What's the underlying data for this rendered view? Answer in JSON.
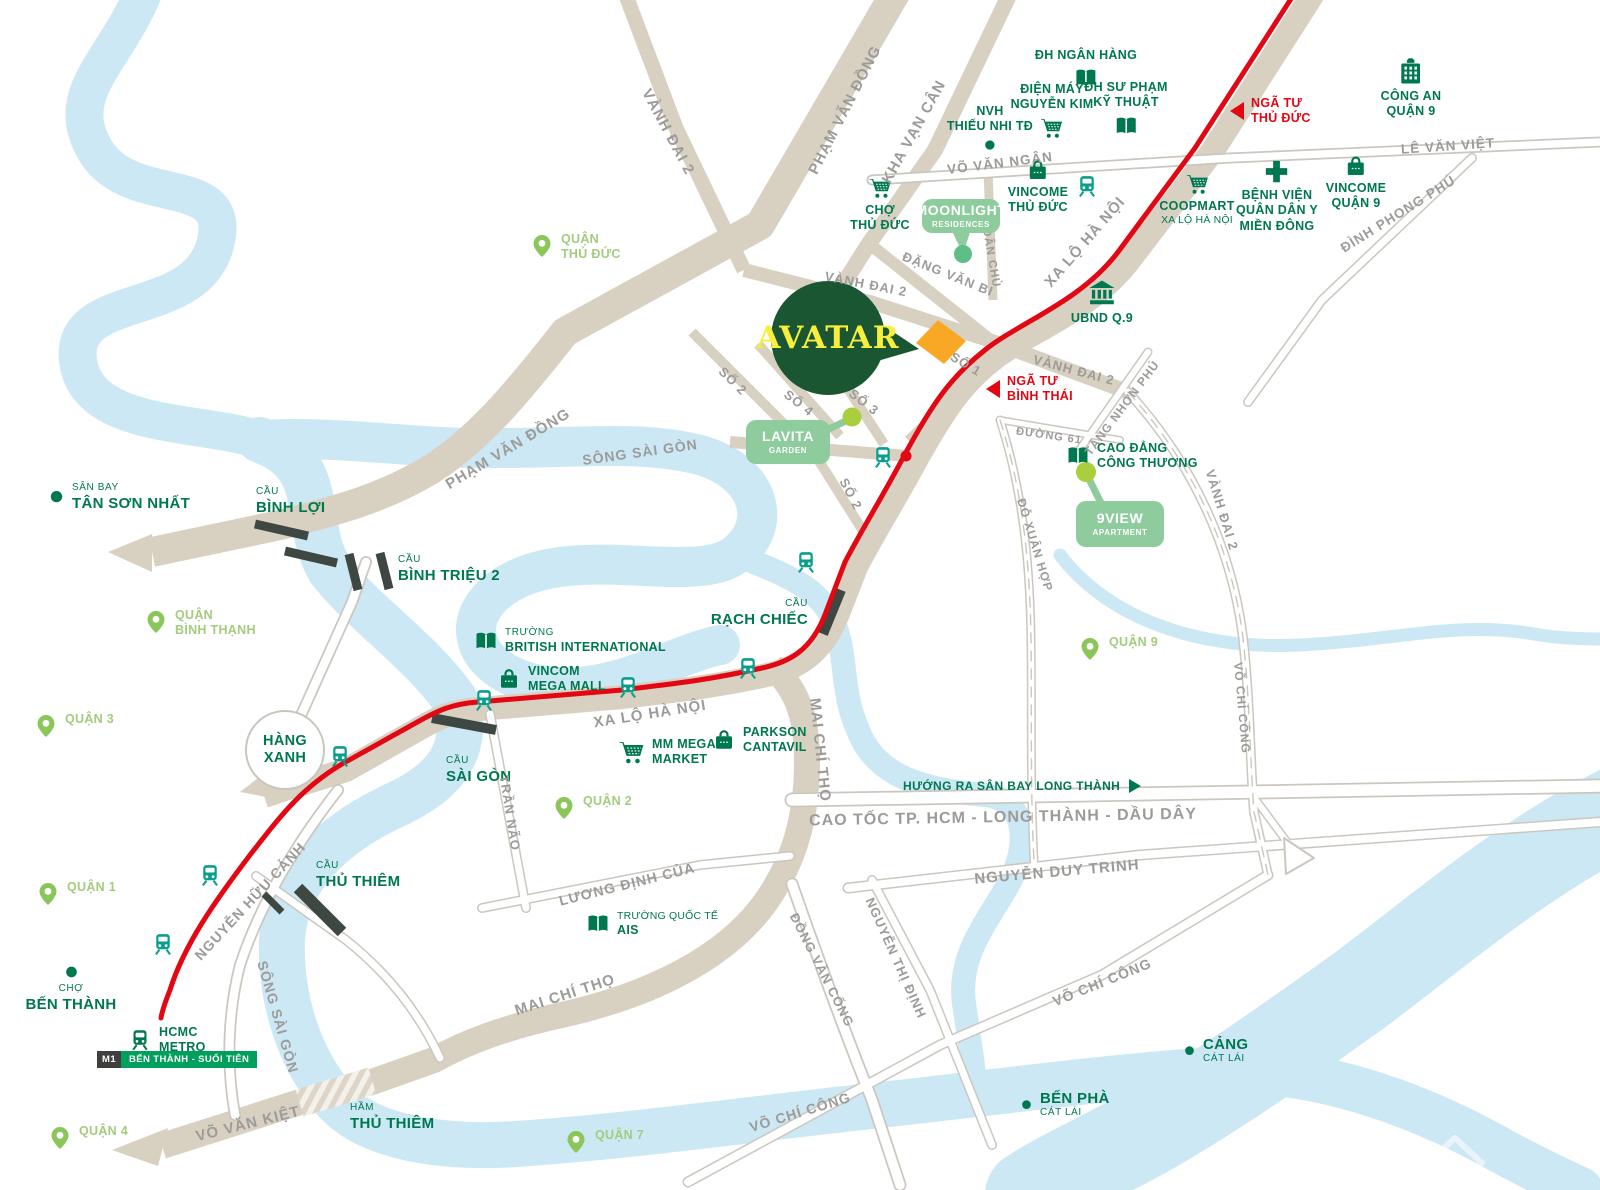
{
  "map": {
    "project": {
      "name": "AVATAR",
      "bubble_color": "#1b5633",
      "text_color": "#f8ef3d",
      "site_color": "#f9a826"
    },
    "colors": {
      "landmark_green": "#00784f",
      "district_green": "#a3cc7d",
      "pin_green": "#8bc65a",
      "metro_red": "#e30613",
      "road_beige": "#d8d1c2",
      "river_blue": "#cde8f5",
      "mint_box": "#8ecb9d",
      "train_teal": "#0a9f8c",
      "label_gray": "#9c9b99",
      "metro_badge_green": "#00a05c",
      "bridge_dark": "#3e4742"
    },
    "hang_xanh": {
      "lines": [
        "HÀNG",
        "XANH"
      ]
    },
    "direction_sign": {
      "text": "HƯỚNG RA SÂN BAY LONG THÀNH",
      "x": 903,
      "y": 779
    },
    "metro": {
      "badge": {
        "m1": "M1",
        "name": "BẾN THÀNH - SUỐI TIÊN",
        "x": 97,
        "y": 1051
      },
      "stations": [
        [
          1087,
          186
        ],
        [
          883,
          457
        ],
        [
          806,
          562
        ],
        [
          748,
          668
        ],
        [
          628,
          687
        ],
        [
          484,
          700
        ],
        [
          340,
          756
        ],
        [
          210,
          875
        ],
        [
          163,
          944
        ]
      ],
      "terminus_dot": [
        906,
        456
      ]
    },
    "districts": [
      {
        "id": "quan-thu-duc",
        "lines": [
          "QUẬN",
          "THỦ ĐỨC"
        ],
        "x": 530,
        "y": 232
      },
      {
        "id": "quan-binh-thanh",
        "lines": [
          "QUẬN",
          "BÌNH THẠNH"
        ],
        "x": 144,
        "y": 608
      },
      {
        "id": "quan-3",
        "lines": [
          "QUẬN 3"
        ],
        "x": 34,
        "y": 712
      },
      {
        "id": "quan-1",
        "lines": [
          "QUẬN 1"
        ],
        "x": 36,
        "y": 880
      },
      {
        "id": "quan-2",
        "lines": [
          "QUẬN 2"
        ],
        "x": 552,
        "y": 794
      },
      {
        "id": "quan-9",
        "lines": [
          "QUẬN 9"
        ],
        "x": 1078,
        "y": 635
      },
      {
        "id": "quan-7",
        "lines": [
          "QUẬN 7"
        ],
        "x": 564,
        "y": 1128
      },
      {
        "id": "quan-4",
        "lines": [
          "QUẬN 4"
        ],
        "x": 48,
        "y": 1124
      }
    ],
    "pois": [
      {
        "id": "dh-ngan-hang",
        "icon": "book",
        "layout": "icon-bottom",
        "x": 1086,
        "y": 48,
        "lines": [
          {
            "t": "ĐH NGÂN HÀNG",
            "c": "md"
          }
        ]
      },
      {
        "id": "dien-may-nguyen-kim",
        "icon": "cart",
        "layout": "icon-bottom",
        "x": 1052,
        "y": 82,
        "lines": [
          {
            "t": "ĐIỆN MÁY",
            "c": "md"
          },
          {
            "t": "NGUYỄN KIM",
            "c": "md"
          }
        ]
      },
      {
        "id": "dh-su-pham-ky-thuat",
        "icon": "book",
        "layout": "icon-bottom",
        "x": 1126,
        "y": 80,
        "lines": [
          {
            "t": "ĐH SƯ PHẠM",
            "c": "md"
          },
          {
            "t": "KỸ THUẬT",
            "c": "md"
          }
        ]
      },
      {
        "id": "nvh-thieu-nhi-td",
        "icon": "dot",
        "is": 14,
        "layout": "icon-bottom",
        "x": 990,
        "y": 104,
        "lines": [
          {
            "t": "NVH",
            "c": "md"
          },
          {
            "t": "THIẾU NHI TĐ",
            "c": "md"
          }
        ]
      },
      {
        "id": "cho-thu-duc",
        "icon": "cart",
        "layout": "icon-top",
        "x": 880,
        "y": 176,
        "lines": [
          {
            "t": "CHỢ",
            "c": "md"
          },
          {
            "t": "THỦ ĐỨC",
            "c": "md"
          }
        ]
      },
      {
        "id": "vincome-thu-duc",
        "icon": "bag",
        "layout": "icon-top",
        "x": 1038,
        "y": 158,
        "lines": [
          {
            "t": "VINCOME",
            "c": "md"
          },
          {
            "t": "THỦ ĐỨC",
            "c": "md"
          }
        ]
      },
      {
        "id": "cong-an-quan-9",
        "icon": "police",
        "is": 30,
        "layout": "icon-top",
        "x": 1411,
        "y": 56,
        "lines": [
          {
            "t": "CÔNG AN",
            "c": "md"
          },
          {
            "t": "QUẬN 9",
            "c": "md"
          }
        ]
      },
      {
        "id": "coopmart-xa-lo-ha-noi",
        "icon": "cart",
        "layout": "icon-top",
        "x": 1197,
        "y": 172,
        "lines": [
          {
            "t": "COOPMART",
            "c": "md"
          },
          {
            "t": "XA LỘ HÀ NỘI",
            "c": "rg"
          }
        ]
      },
      {
        "id": "benh-vien-quan-dan-y-mien-dong",
        "icon": "cross",
        "is": 27,
        "layout": "icon-top",
        "x": 1277,
        "y": 158,
        "lines": [
          {
            "t": "BỆNH VIỆN",
            "c": "md"
          },
          {
            "t": "QUÂN DÂN Y",
            "c": "md"
          },
          {
            "t": "MIỀN ĐÔNG",
            "c": "md"
          }
        ]
      },
      {
        "id": "vincome-quan-9",
        "icon": "bag",
        "layout": "icon-top",
        "x": 1356,
        "y": 154,
        "lines": [
          {
            "t": "VINCOME",
            "c": "md"
          },
          {
            "t": "QUẬN 9",
            "c": "md"
          }
        ]
      },
      {
        "id": "ubnd-q9",
        "icon": "bank",
        "is": 30,
        "layout": "icon-top",
        "x": 1102,
        "y": 278,
        "lines": [
          {
            "t": "UBND Q.9",
            "c": "md"
          }
        ]
      },
      {
        "id": "cao-dang-cong-thuong",
        "icon": "book",
        "layout": "icon-left",
        "x": 1066,
        "y": 456,
        "lines": [
          {
            "t": "CAO ĐẲNG",
            "c": "md"
          },
          {
            "t": "CÔNG THƯƠNG",
            "c": "md"
          }
        ]
      },
      {
        "id": "truong-british-international",
        "icon": "book",
        "layout": "icon-left",
        "x": 474,
        "y": 641,
        "lines": [
          {
            "t": "TRƯỜNG",
            "c": "sm"
          },
          {
            "t": "BRITISH INTERNATIONAL",
            "c": "md"
          }
        ]
      },
      {
        "id": "vincom-mega-mall",
        "icon": "bag",
        "layout": "icon-left",
        "x": 497,
        "y": 679,
        "lines": [
          {
            "t": "VINCOM",
            "c": "md"
          },
          {
            "t": "MEGA MALL",
            "c": "md"
          }
        ]
      },
      {
        "id": "mm-mega-market",
        "icon": "cart",
        "is": 27,
        "layout": "icon-left",
        "x": 618,
        "y": 752,
        "lines": [
          {
            "t": "MM MEGA",
            "c": "md"
          },
          {
            "t": "MARKET",
            "c": "md"
          }
        ]
      },
      {
        "id": "parkson-cantavil",
        "icon": "bag",
        "layout": "icon-left",
        "x": 712,
        "y": 740,
        "lines": [
          {
            "t": "PARKSON",
            "c": "md"
          },
          {
            "t": "CANTAVIL",
            "c": "md"
          }
        ]
      },
      {
        "id": "truong-quoc-te-ais",
        "icon": "book",
        "layout": "icon-left",
        "x": 586,
        "y": 924,
        "lines": [
          {
            "t": "TRƯỜNG QUỐC TẾ",
            "c": "rg"
          },
          {
            "t": "AIS",
            "c": "md"
          }
        ]
      },
      {
        "id": "san-bay-tan-son-nhat",
        "icon": "dot",
        "is": 17,
        "layout": "icon-left",
        "x": 48,
        "y": 497,
        "lines": [
          {
            "t": "SÂN BAY",
            "c": "sm"
          },
          {
            "t": "TÂN SƠN NHẤT",
            "c": "lg"
          }
        ]
      },
      {
        "id": "cho-ben-thanh",
        "icon": "dot",
        "is": 16,
        "layout": "icon-top",
        "x": 71,
        "y": 964,
        "lines": [
          {
            "t": "CHỢ",
            "c": "sm"
          },
          {
            "t": "BẾN THÀNH",
            "c": "lg"
          }
        ]
      },
      {
        "id": "cang-cat-lai",
        "icon": "dot",
        "is": 13,
        "layout": "icon-left",
        "x": 1183,
        "y": 1051,
        "lines": [
          {
            "t": "CẢNG",
            "c": "lg"
          },
          {
            "t": "CÁT LÁI",
            "c": "sm"
          }
        ]
      },
      {
        "id": "ben-pha-cat-lai",
        "icon": "dot",
        "is": 13,
        "layout": "icon-left",
        "x": 1020,
        "y": 1105,
        "lines": [
          {
            "t": "BẾN PHÀ",
            "c": "lg"
          },
          {
            "t": "CÁT LÁI",
            "c": "sm"
          }
        ]
      },
      {
        "id": "hcmc-metro",
        "icon": "train",
        "layout": "icon-left",
        "x": 128,
        "y": 1040,
        "lines": [
          {
            "t": "HCMC",
            "c": "md"
          },
          {
            "t": "METRO",
            "c": "md"
          }
        ]
      },
      {
        "id": "cau-binh-loi",
        "layout": "tonly",
        "x": 256,
        "y": 486,
        "lines": [
          {
            "t": "CẦU",
            "c": "sm"
          },
          {
            "t": "BÌNH LỢI",
            "c": "lg"
          }
        ]
      },
      {
        "id": "cau-binh-trieu-2",
        "layout": "tonly",
        "x": 398,
        "y": 554,
        "lines": [
          {
            "t": "CẦU",
            "c": "sm"
          },
          {
            "t": "BÌNH TRIỆU 2",
            "c": "lg"
          }
        ]
      },
      {
        "id": "cau-sai-gon",
        "layout": "tonly",
        "x": 446,
        "y": 755,
        "lines": [
          {
            "t": "CẦU",
            "c": "sm"
          },
          {
            "t": "SÀI GÒN",
            "c": "lg"
          }
        ]
      },
      {
        "id": "cau-rach-chiec",
        "layout": "tonly",
        "align": "right",
        "x": 808,
        "y": 598,
        "lines": [
          {
            "t": "CẦU",
            "c": "sm"
          },
          {
            "t": "RẠCH CHIẾC",
            "c": "lg"
          }
        ]
      },
      {
        "id": "cau-thu-thiem",
        "layout": "tonly",
        "x": 316,
        "y": 860,
        "lines": [
          {
            "t": "CẦU",
            "c": "sm"
          },
          {
            "t": "THỦ THIÊM",
            "c": "lg"
          }
        ]
      },
      {
        "id": "ham-thu-thiem",
        "layout": "tonly",
        "x": 350,
        "y": 1102,
        "lines": [
          {
            "t": "HẦM",
            "c": "sm"
          },
          {
            "t": "THỦ THIÊM",
            "c": "lg"
          }
        ]
      }
    ],
    "road_labels": [
      {
        "t": "VÀNH ĐAI 2",
        "x": 668,
        "y": 132,
        "r": 62,
        "s": 15
      },
      {
        "t": "PHẠM VĂN ĐỒNG",
        "x": 845,
        "y": 110,
        "r": -63,
        "s": 15
      },
      {
        "t": "KHA VẠN CÂN",
        "x": 914,
        "y": 132,
        "r": -61,
        "s": 15
      },
      {
        "t": "VÕ VĂN NGÂN",
        "x": 1000,
        "y": 163,
        "r": -7,
        "s": 13.5
      },
      {
        "t": "LÊ VĂN VIỆT",
        "x": 1448,
        "y": 146,
        "r": -4,
        "s": 13.5
      },
      {
        "t": "ĐÌNH PHONG PHÚ",
        "x": 1398,
        "y": 214,
        "r": -32,
        "s": 13.5
      },
      {
        "t": "XA LỘ HÀ NỘI",
        "x": 1085,
        "y": 242,
        "r": -49,
        "s": 15
      },
      {
        "t": "DÂN CHỦ",
        "x": 991,
        "y": 258,
        "r": 80,
        "s": 11.5
      },
      {
        "t": "ĐẶNG VĂN BI",
        "x": 948,
        "y": 274,
        "r": 22,
        "s": 13
      },
      {
        "t": "VÀNH ĐAI 2",
        "x": 866,
        "y": 284,
        "r": 11,
        "s": 13
      },
      {
        "t": "SỐ 1",
        "x": 966,
        "y": 364,
        "r": 31,
        "s": 13
      },
      {
        "t": "VÀNH ĐAI 2",
        "x": 1074,
        "y": 370,
        "r": 15,
        "s": 13
      },
      {
        "t": "SỐ 2",
        "x": 733,
        "y": 381,
        "r": 44,
        "s": 13
      },
      {
        "t": "SỐ 4",
        "x": 799,
        "y": 403,
        "r": 38,
        "s": 13
      },
      {
        "t": "SỐ 3",
        "x": 864,
        "y": 402,
        "r": 38,
        "s": 13
      },
      {
        "t": "SỐ 2",
        "x": 851,
        "y": 494,
        "r": 62,
        "s": 13
      },
      {
        "t": "ĐƯỜNG 61",
        "x": 1049,
        "y": 436,
        "r": 8,
        "s": 11
      },
      {
        "t": "TĂNG NHƠN PHÚ",
        "x": 1122,
        "y": 408,
        "r": -53,
        "s": 12
      },
      {
        "t": "ĐỖ XUÂN HỢP",
        "x": 1035,
        "y": 545,
        "r": 73,
        "s": 12
      },
      {
        "t": "VÀNH ĐAI 2",
        "x": 1222,
        "y": 510,
        "r": 73,
        "s": 13
      },
      {
        "t": "VÕ CHÍ CÔNG",
        "x": 1242,
        "y": 708,
        "r": 85,
        "s": 12
      },
      {
        "t": "PHẠM VĂN ĐỒNG",
        "x": 508,
        "y": 449,
        "r": -31,
        "s": 15
      },
      {
        "t": "SÔNG SÀI GÒN",
        "x": 640,
        "y": 452,
        "r": -8,
        "s": 14
      },
      {
        "t": "XA LỘ HÀ NỘI",
        "x": 650,
        "y": 714,
        "r": -9,
        "s": 15
      },
      {
        "t": "MAI CHÍ THỌ",
        "x": 820,
        "y": 750,
        "r": 84,
        "s": 15
      },
      {
        "t": "TRẦN NÃO",
        "x": 510,
        "y": 813,
        "r": 81,
        "s": 13
      },
      {
        "t": "LƯƠNG ĐỊNH CỦA",
        "x": 627,
        "y": 884,
        "r": -14,
        "s": 14
      },
      {
        "t": "CAO TỐC TP. HCM - LONG THÀNH - DẦU DÂY",
        "x": 1003,
        "y": 818,
        "r": -1,
        "s": 16
      },
      {
        "t": "NGUYỄN DUY TRINH",
        "x": 1057,
        "y": 872,
        "r": -5,
        "s": 15
      },
      {
        "t": "NGUYỄN HỮU CẢNH",
        "x": 250,
        "y": 901,
        "r": -47,
        "s": 14
      },
      {
        "t": "SÔNG SÀI GÒN",
        "x": 278,
        "y": 1017,
        "r": 74,
        "s": 14
      },
      {
        "t": "VÕ VĂN KIỆT",
        "x": 248,
        "y": 1124,
        "r": -14,
        "s": 15
      },
      {
        "t": "MAI CHÍ THỌ",
        "x": 565,
        "y": 995,
        "r": -18,
        "s": 15
      },
      {
        "t": "ĐỒNG VĂN CỐNG",
        "x": 822,
        "y": 970,
        "r": 63,
        "s": 13
      },
      {
        "t": "NGUYỄN THỊ ĐỊNH",
        "x": 896,
        "y": 958,
        "r": 66,
        "s": 13
      },
      {
        "t": "VÕ CHÍ CÔNG",
        "x": 1102,
        "y": 982,
        "r": -22,
        "s": 14
      },
      {
        "t": "VÕ CHÍ CÔNG",
        "x": 800,
        "y": 1112,
        "r": -17,
        "s": 14
      }
    ],
    "intersections": [
      {
        "id": "nga-tu-thu-duc",
        "lines": [
          "NGÃ TƯ",
          "THỦ ĐỨC"
        ],
        "x": 1230,
        "y": 96
      },
      {
        "id": "nga-tu-binh-thai",
        "lines": [
          "NGÃ TƯ",
          "BÌNH THÁI"
        ],
        "x": 986,
        "y": 374
      }
    ],
    "callouts": [
      {
        "id": "moonlight-residences",
        "cx": 961,
        "cy": 216,
        "w": 78,
        "h": 34,
        "l1": "MOONLIGHT",
        "l2": "RESIDENCES"
      },
      {
        "id": "lavita-garden",
        "cx": 788,
        "cy": 442,
        "w": 84,
        "h": 44,
        "l1": "LAVITA",
        "l2": "GARDEN"
      },
      {
        "id": "9view-apartment",
        "cx": 1120,
        "cy": 524,
        "w": 88,
        "h": 46,
        "l1": "9VIEW",
        "l2": "APARTMENT"
      }
    ]
  }
}
